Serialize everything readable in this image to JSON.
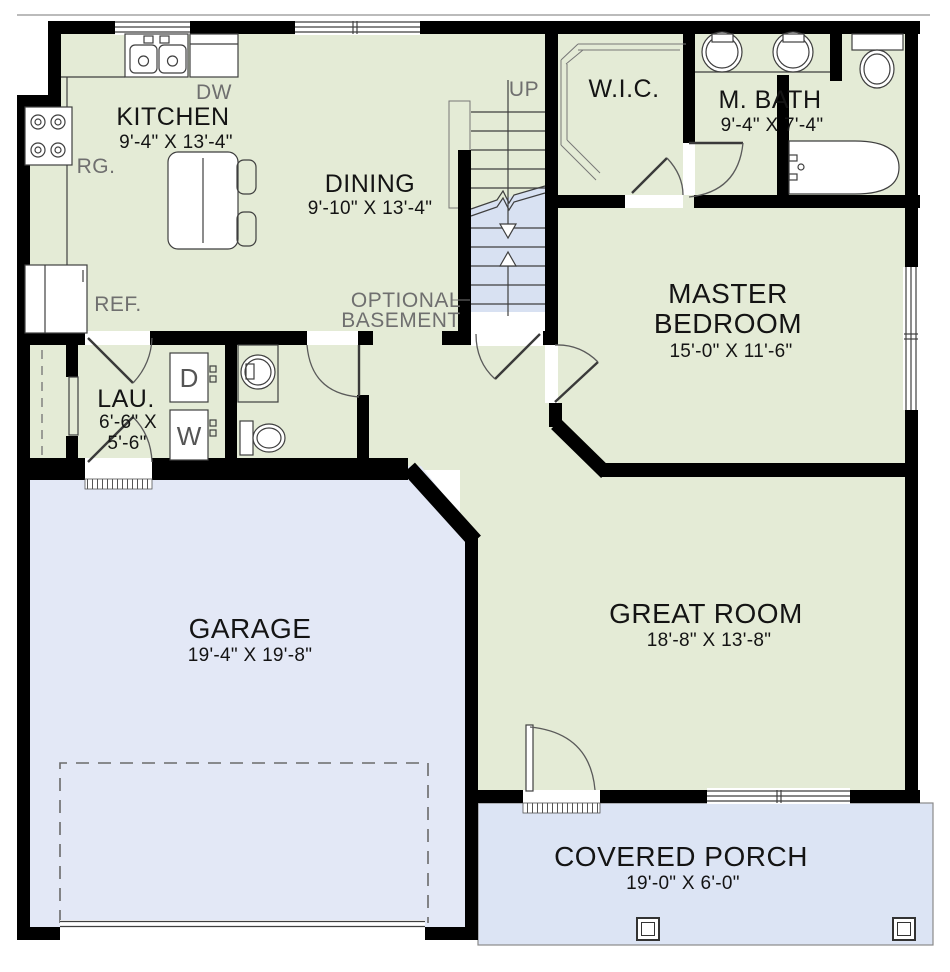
{
  "colors": {
    "wall": "#000000",
    "line": "#3f3f3f",
    "thin": "#777777",
    "room-green": "#e4ebd6",
    "garage-blue": "#e3e8f6",
    "porch-blue": "#dce4f4",
    "stair-blue": "#d8e1f2",
    "text-dark": "#141414",
    "text-gray": "#6f6f6f",
    "paper": "#ffffff"
  },
  "rooms": {
    "kitchen": {
      "name": "KITCHEN",
      "dims": "9'-4\" X 13'-4\""
    },
    "dining": {
      "name": "DINING",
      "dims": "9'-10\" X 13'-4\""
    },
    "wic": {
      "name": "W.I.C."
    },
    "master_bath": {
      "name": "M. BATH",
      "dims": "9'-4\" X 7'-4\""
    },
    "master_bedroom": {
      "name_line1": "MASTER",
      "name_line2": "BEDROOM",
      "dims": "15'-0\" X 11'-6\""
    },
    "laundry": {
      "name": "LAU.",
      "dims_line1": "6'-6\" X",
      "dims_line2": "5'-6\""
    },
    "great_room": {
      "name": "GREAT ROOM",
      "dims": "18'-8\" X 13'-8\""
    },
    "garage": {
      "name": "GARAGE",
      "dims": "19'-4\" X 19'-8\""
    },
    "covered_porch": {
      "name": "COVERED PORCH",
      "dims": "19'-0\" X 6'-0\""
    }
  },
  "annotations": {
    "stairs_up": "UP",
    "optional_basement_line1": "OPTIONAL",
    "optional_basement_line2": "BASEMENT",
    "dishwasher": "DW",
    "range": "RG.",
    "refrigerator": "REF.",
    "dryer": "D",
    "washer": "W"
  }
}
